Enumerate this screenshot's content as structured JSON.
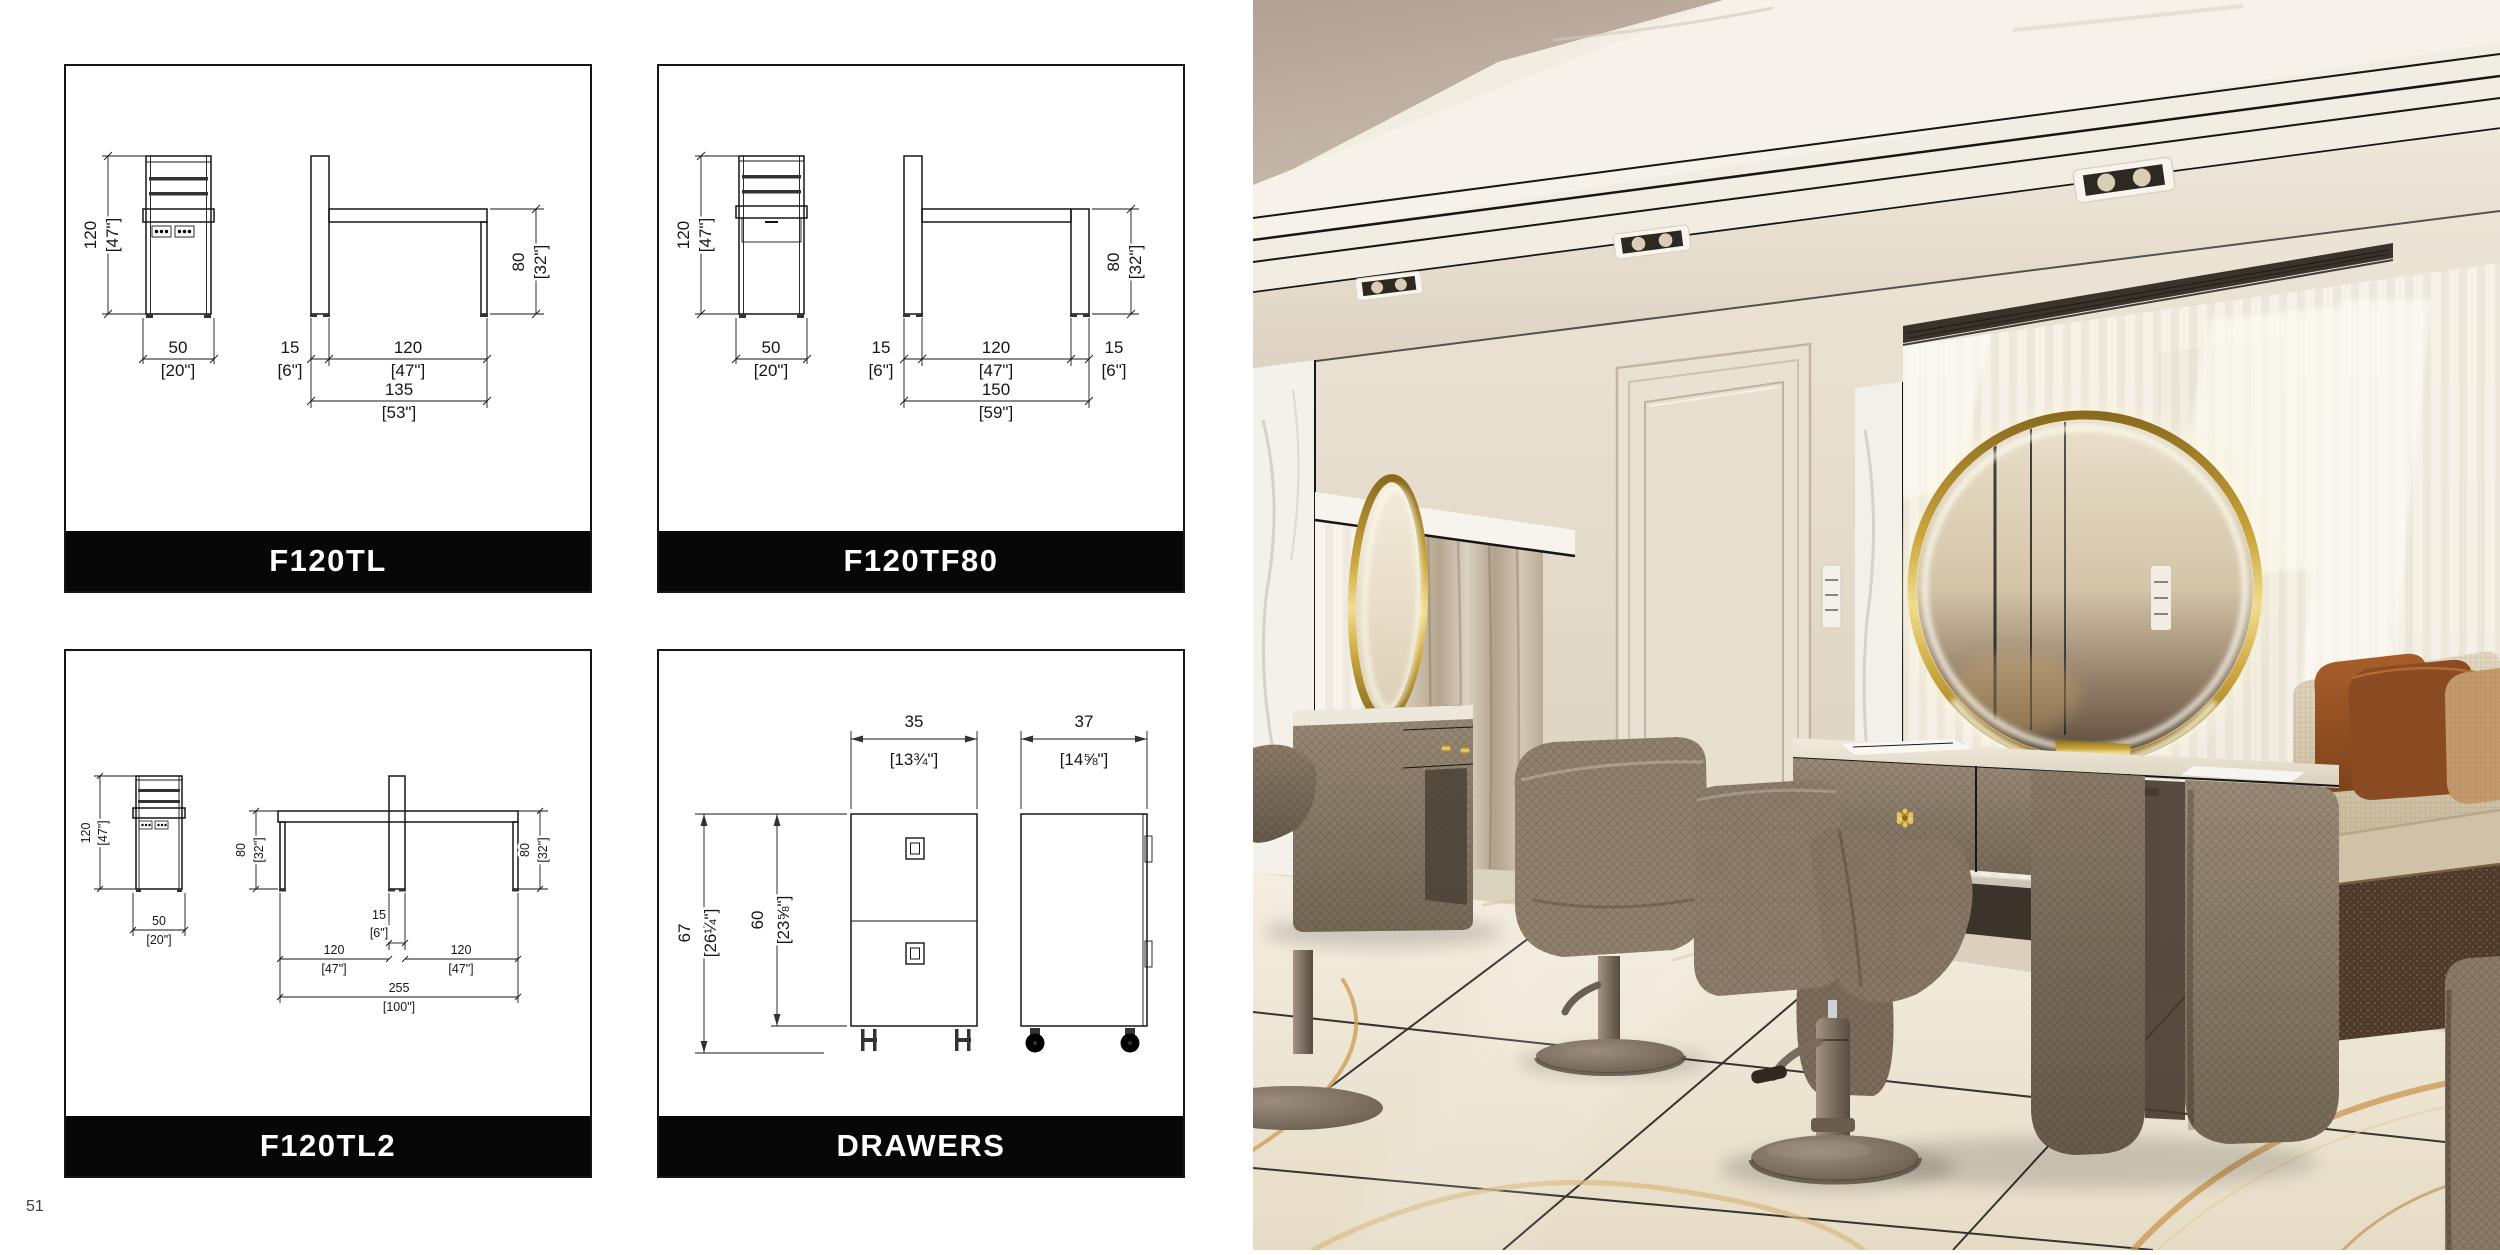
{
  "page": {
    "number": "51"
  },
  "panels": [
    {
      "code": "F120TL",
      "h": "120",
      "h_in": "[47\"]",
      "w": "50",
      "w_in": "[20\"]",
      "d": "15",
      "d_in": "[6\"]",
      "l": "120",
      "l_in": "[47\"]",
      "t": "135",
      "t_in": "[53\"]",
      "bh": "80",
      "bh_in": "[32\"]"
    },
    {
      "code": "F120TF80",
      "h": "120",
      "h_in": "[47\"]",
      "w": "50",
      "w_in": "[20\"]",
      "d": "15",
      "d_in": "[6\"]",
      "l": "120",
      "l_in": "[47\"]",
      "d2": "15",
      "d2_in": "[6\"]",
      "t": "150",
      "t_in": "[59\"]",
      "bh": "80",
      "bh_in": "[32\"]"
    },
    {
      "code": "F120TL2",
      "h": "120",
      "h_in": "[47\"]",
      "w": "50",
      "w_in": "[20\"]",
      "hl": "80",
      "hl_in": "[32\"]",
      "hr": "80",
      "hr_in": "[32\"]",
      "c": "15",
      "c_in": "[6\"]",
      "l1": "120",
      "l1_in": "[47\"]",
      "l2": "120",
      "l2_in": "[47\"]",
      "t": "255",
      "t_in": "[100\"]"
    },
    {
      "code": "DRAWERS",
      "w1": "35",
      "w1_in": "[13¾\"]",
      "w2": "37",
      "w2_in": "[14⅝\"]",
      "h1": "67",
      "h1_in": "[26¼\"]",
      "h2": "60",
      "h2_in": "[23⅝\"]"
    }
  ],
  "photo": {
    "palette": {
      "wall": "#e4dccd",
      "ceiling_tan": "#b9a999",
      "molding": "#f3efe7",
      "floor_marble": "#f0e9dc",
      "floor_vein_gold": "#c9954d",
      "furniture_taupe": "#8a7b68",
      "gold_accent": "#caa63c",
      "led_glow": "#fff8dd",
      "sofa_linen": "#d9ceb5",
      "pillow_rust": "#9a5426",
      "pillow_tan": "#c49a6b",
      "rug_brown": "#4e3a2a"
    }
  }
}
